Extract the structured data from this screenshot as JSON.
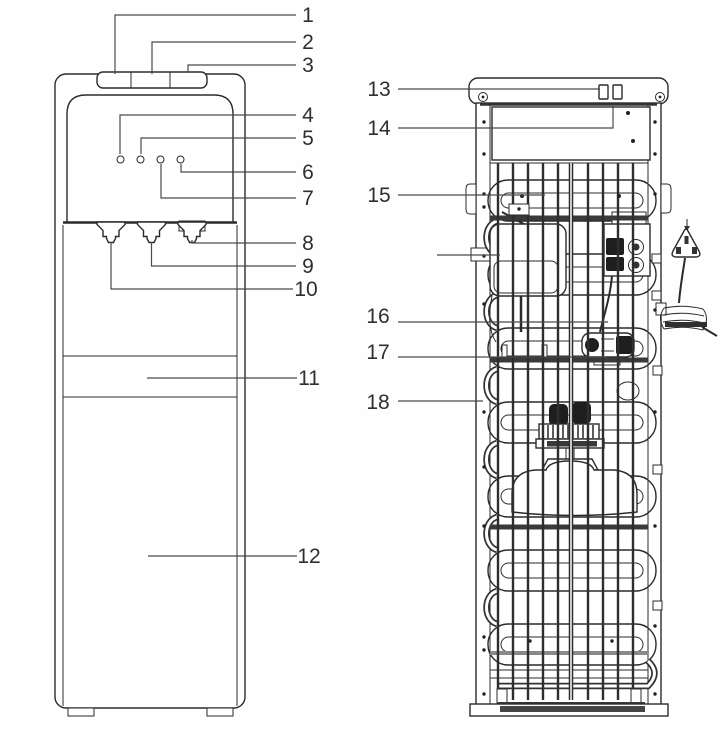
{
  "callouts": {
    "front": [
      "1",
      "2",
      "3",
      "4",
      "5",
      "6",
      "7",
      "8",
      "9",
      "10",
      "11",
      "12"
    ],
    "back": [
      "13",
      "14",
      "15",
      "16",
      "17",
      "18"
    ]
  },
  "colors": {
    "line": "#2b2b2b",
    "leader": "#4a4a4a",
    "label_text": "#2f2f2f",
    "dark_component": "#1e1e1e",
    "background": "#fefefe"
  }
}
